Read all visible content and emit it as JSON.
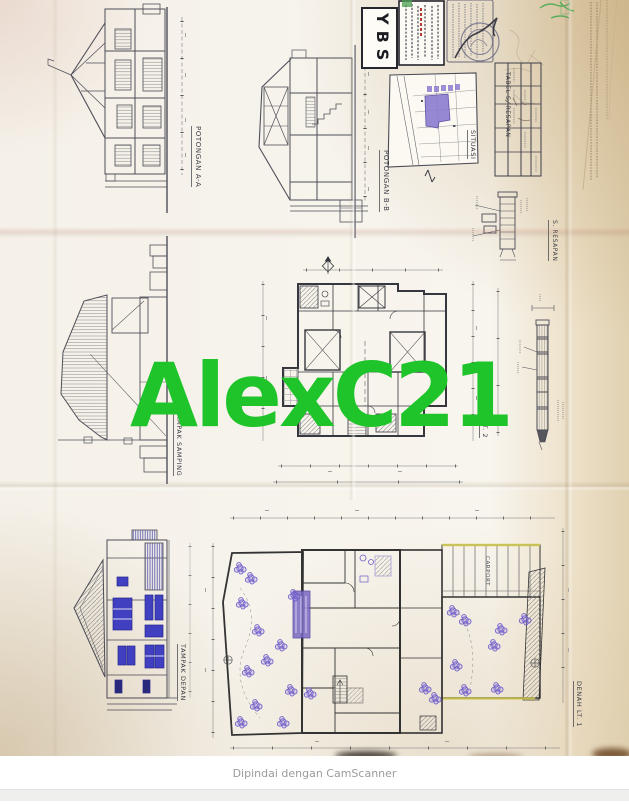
{
  "watermark": {
    "text": "AlexC21",
    "color": "#1fc32a"
  },
  "footer": {
    "scan_note": "Dipindai dengan CamScanner"
  },
  "title_block": {
    "company": "YBS"
  },
  "labels": {
    "potongan_aa": "POTONGAN A-A",
    "potongan_bb": "POTONGAN B-B",
    "situasi": "SITUASI",
    "tabel_resapan": "TABEL S. RESAPAN",
    "s_resapan": "S. RESAPAN",
    "tampak_samping": "TAMPAK SAMPING",
    "denah_lt2": "DENAH LT. 2",
    "tampak_depan": "TAMPAK DEPAN",
    "denah_lt1": "DENAH LT. 1",
    "carport": "CARPORT"
  }
}
